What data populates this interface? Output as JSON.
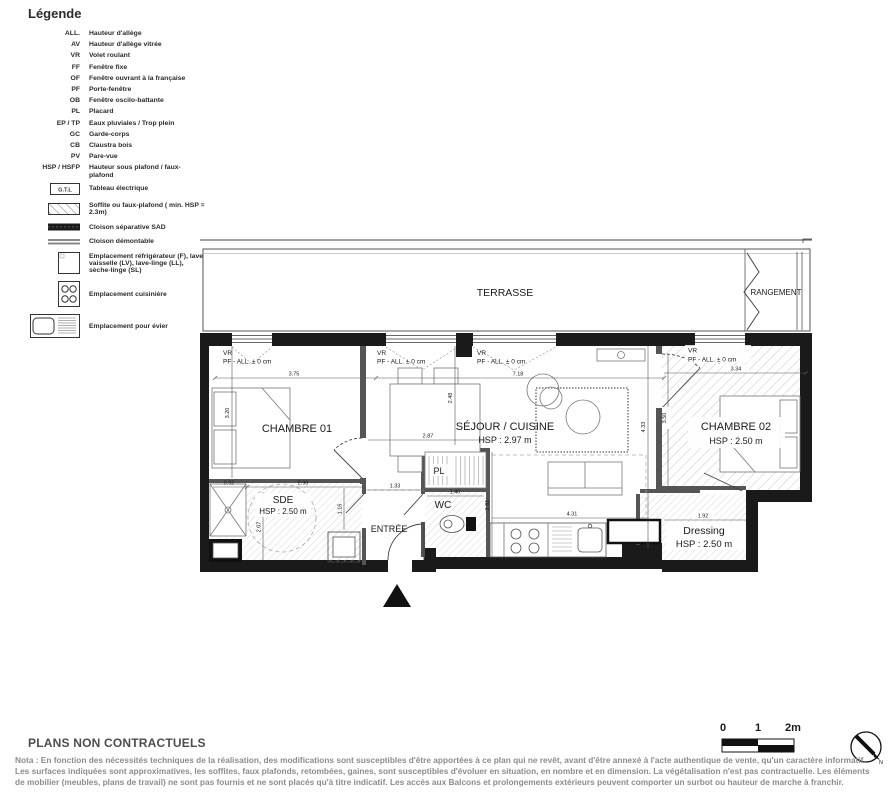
{
  "legend": {
    "title": "Légende",
    "abbreviations": [
      {
        "abbr": "ALL.",
        "label": "Hauteur d'allège"
      },
      {
        "abbr": "AV",
        "label": "Hauteur d'allège vitrée"
      },
      {
        "abbr": "VR",
        "label": "Volet roulant"
      },
      {
        "abbr": "FF",
        "label": "Fenêtre fixe"
      },
      {
        "abbr": "OF",
        "label": "Fenêtre ouvrant à la française"
      },
      {
        "abbr": "PF",
        "label": "Porte-fenêtre"
      },
      {
        "abbr": "OB",
        "label": "Fenêtre oscilo-battante"
      },
      {
        "abbr": "PL",
        "label": "Placard"
      },
      {
        "abbr": "EP / TP",
        "label": "Eaux pluviales / Trop plein"
      },
      {
        "abbr": "GC",
        "label": "Garde-corps"
      },
      {
        "abbr": "CB",
        "label": "Claustra bois"
      },
      {
        "abbr": "PV",
        "label": "Pare-vue"
      },
      {
        "abbr": "HSP / HSFP",
        "label": "Hauteur sous plafond / faux-plafond"
      }
    ],
    "symbols": [
      {
        "icon": "gtl-box",
        "box_label": "G.T.L",
        "text": "Tableau électrique"
      },
      {
        "icon": "soffit-hatch",
        "text": "Soffite ou faux-plafond ( min. HSP = 2.3m)"
      },
      {
        "icon": "separating-wall",
        "text": "Cloison séparative SAD"
      },
      {
        "icon": "removable-wall",
        "text": "Cloison démontable"
      },
      {
        "icon": "appliance-box",
        "text": "Emplacement réfrigérateur (F), lave-vaisselle (LV), lave-linge (LL), sèche-linge (SL)"
      },
      {
        "icon": "stove",
        "text": "Emplacement cuisinière"
      },
      {
        "icon": "sink",
        "text": "Emplacement pour évier"
      }
    ]
  },
  "plan": {
    "terrasse": "TERRASSE",
    "rangement": "RANGEMENT",
    "chambre01": "CHAMBRE 01",
    "sejour": "SÉJOUR / CUISINE",
    "sejour_hsp": "HSP : 2.97 m",
    "chambre02": "CHAMBRE 02",
    "chambre02_hsp": "HSP : 2.50 m",
    "sde": "SDE",
    "sde_hsp": "HSP : 2.50 m",
    "wc": "WC",
    "entree": "ENTRÉE",
    "pl": "PL",
    "dressing": "Dressing",
    "dressing_hsp": "HSP : 2.50 m",
    "window_vr": "VR",
    "window_pf": "PF - ALL. ± 0 cm",
    "dims": {
      "w_ch1": "3.75",
      "w_sejour": "7.18",
      "w_ch2": "3.34",
      "h_ch1": "3.20",
      "h_sejour": "2.48",
      "h_right": "4.33",
      "sde_w": "2.87",
      "h_ch2": "3.50",
      "kitchen_h": "2.81",
      "kitchen_w": "4.31",
      "entree_w": "1.33",
      "wc_w": "1.40",
      "sde_a": "0.92",
      "sde_b": "2.90",
      "sde_c": "1.16",
      "sde_d": "2.07",
      "dressing_w": "1.92"
    }
  },
  "scalebar": {
    "zero": "0",
    "one": "1",
    "two": "2m"
  },
  "compass": {
    "north": "N"
  },
  "footer": {
    "title": "PLANS NON CONTRACTUELS",
    "nota": "Nota : En fonction des nécessités techniques de la réalisation, des modifications sont susceptibles d'être apportées à ce plan qui ne revêt, avant d'être annexé à l'acte authentique de vente, qu'un caractère informatif. Les surfaces indiquées sont approximatives, les soffites, faux plafonds, retombées, gaines, sont susceptibles d'évoluer en situation, en nombre et en dimension. La végétalisation n'est pas contractuelle. Les éléments de mobilier (meubles, plans de travail) ne sont pas fournis et ne sont placés qu'à titre indicatif. Les accès aux Balcons et prolongements extérieurs peuvent comporter un surbot ou hauteur de marche à franchir."
  }
}
